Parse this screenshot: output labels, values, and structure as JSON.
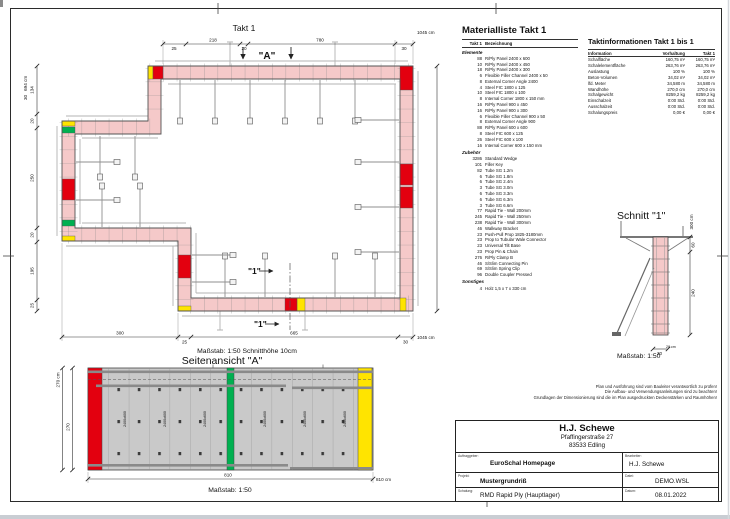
{
  "colors": {
    "wall_pink": "#f5c9c9",
    "accent_red": "#e3000f",
    "accent_green": "#00b050",
    "accent_yellow": "#ffe400",
    "panel_gray": "#c9c9c9",
    "wale_gray": "#b3b3b3",
    "line_dark": "#333333"
  },
  "sheet": {
    "plan_title": "Takt 1",
    "plan_scale": "Maßstab: 1:50   Schnitthöhe 10cm",
    "elevation_title": "Seitenansicht \"A\"",
    "elevation_scale": "Maßstab: 1:50",
    "section_title": "Schnitt \"1\"",
    "section_scale": "Maßstab: 1:50"
  },
  "markers": {
    "a": "\"A\"",
    "s1": "\"1\""
  },
  "dims": {
    "plan_top": [
      "25",
      "218",
      "20",
      "780",
      "30",
      "1045 cm"
    ],
    "plan_left_thickness": "30",
    "plan_left_total": "694 cm",
    "plan_left": [
      "134",
      "20",
      "250",
      "20",
      "195",
      "25"
    ],
    "plan_bottom": [
      "300",
      "25",
      "665",
      "30",
      "1045 cm"
    ],
    "elevation_total": "270 cm",
    "elevation_height": "270",
    "elevation_width": "810",
    "elevation_width_total": "810 cm",
    "section_total": "300 cm",
    "section_upper": "60",
    "section_lower": "240",
    "section_thickness": "30",
    "section_extra": "28 cm"
  },
  "elevation": {
    "panel_label": "2400x600"
  },
  "material_list": {
    "title": "Materialliste  Takt 1",
    "col_qty": "Takt 1",
    "col_name": "Bezeichnung",
    "section1": "Elemente",
    "items1": [
      {
        "qty": "88",
        "name": "R/Ply Panel 2400 x 600"
      },
      {
        "qty": "10",
        "name": "R/Ply Panel 2400 x 450"
      },
      {
        "qty": "18",
        "name": "R/Ply Panel 2400 x 300"
      },
      {
        "qty": "6",
        "name": "Flexible Filler Channel 2400 x 50"
      },
      {
        "qty": "8",
        "name": "External Corner Angle 2400"
      },
      {
        "qty": "4",
        "name": "Steel FIC 1800 x 125"
      },
      {
        "qty": "10",
        "name": "Steel FIC 1800 x 100"
      },
      {
        "qty": "8",
        "name": "Internal Corner 1800 x 150 mm"
      },
      {
        "qty": "16",
        "name": "R/Ply Panel 900 x 450"
      },
      {
        "qty": "16",
        "name": "R/Ply Panel 900 x 300"
      },
      {
        "qty": "6",
        "name": "Flexible Filler Channel 900 x 50"
      },
      {
        "qty": "8",
        "name": "External Corner Angle 900"
      },
      {
        "qty": "88",
        "name": "R/Ply Panel 600 x 600"
      },
      {
        "qty": "8",
        "name": "Steel FIC 600 x 125"
      },
      {
        "qty": "26",
        "name": "Steel FIC 600 x 100"
      },
      {
        "qty": "16",
        "name": "Internal Corner 600 x 150 mm"
      }
    ],
    "section2": "Zubehör",
    "items2": [
      {
        "qty": "3286",
        "name": "Standard Wedge"
      },
      {
        "qty": "101",
        "name": "Filler Key"
      },
      {
        "qty": "82",
        "name": "Tube SG 1.2m"
      },
      {
        "qty": "6",
        "name": "Tube SG 1.8m"
      },
      {
        "qty": "6",
        "name": "Tube SG 2.4m"
      },
      {
        "qty": "3",
        "name": "Tube SG 3.0m"
      },
      {
        "qty": "6",
        "name": "Tube SG 3.3m"
      },
      {
        "qty": "6",
        "name": "Tube SG 6.3m"
      },
      {
        "qty": "3",
        "name": "Tube SG 6.6m"
      },
      {
        "qty": "77",
        "name": "Rapid Tie - Wall  200mm"
      },
      {
        "qty": "245",
        "name": "Rapid Tie - Wall  250mm"
      },
      {
        "qty": "238",
        "name": "Rapid Tie - Wall  300mm"
      },
      {
        "qty": "46",
        "name": "Walkway Bracket"
      },
      {
        "qty": "23",
        "name": "Push-Pull Prop 1825-3180mm"
      },
      {
        "qty": "23",
        "name": "Prop to Tubular Wale Connector"
      },
      {
        "qty": "23",
        "name": "Universal Tilt Base"
      },
      {
        "qty": "23",
        "name": "Prop Pin & Chain"
      },
      {
        "qty": "276",
        "name": "R/Ply Clamp B"
      },
      {
        "qty": "46",
        "name": "S/Slim Connecting Pin"
      },
      {
        "qty": "69",
        "name": "S/Slim Spring Clip"
      },
      {
        "qty": "96",
        "name": "Double Coupler Pressed"
      }
    ],
    "section3": "Sonstiges",
    "items3": [
      {
        "qty": "4",
        "name": "Holz 1,5 x 7 x 330 cm"
      }
    ]
  },
  "takt_info": {
    "title": "Taktinformationen  Takt 1 bis 1",
    "col_info": "Information",
    "col_vorhaltung": "Vorhaltung",
    "col_takt": "Takt 1",
    "rows": [
      {
        "label": "Schalfläche",
        "vorhaltung": "160,75 m²",
        "takt1": "160,75 m²"
      },
      {
        "label": "Schalelementfläche",
        "vorhaltung": "263,76 m²",
        "takt1": "263,76 m²"
      },
      {
        "label": "Auslastung",
        "vorhaltung": "100 %",
        "takt1": "100 %"
      },
      {
        "label": "Beton-Volumen",
        "vorhaltung": "34,02 m³",
        "takt1": "34,02 m³"
      },
      {
        "label": "lfd. Meter",
        "vorhaltung": "34,580 m",
        "takt1": "34,580 m"
      },
      {
        "label": "Wandhöhe",
        "vorhaltung": "270,0 cm",
        "takt1": "270,0 cm"
      },
      {
        "label": "Schalgewicht",
        "vorhaltung": "8259,2 kg",
        "takt1": "8259,2 kg"
      },
      {
        "label": "Einschalzeit",
        "vorhaltung": "0:00 Std.",
        "takt1": "0:00 Std."
      },
      {
        "label": "Ausschalzeit",
        "vorhaltung": "0:00 Std.",
        "takt1": "0:00 Std."
      },
      {
        "label": "Schalungspreis",
        "vorhaltung": "0,00 €",
        "takt1": "0,00 €"
      }
    ]
  },
  "notes": {
    "lines": [
      "Plan und Ausführung sind vom Bauleiter verantwortlich zu prüfen!",
      "Die Aufbau- und Verwendungsanleitungen sind zu beachten!",
      "Grundlagen der Dimensionierung sind die im Plan ausgedruckten Deckenstärken und Raumhöhen!"
    ]
  },
  "title_block": {
    "company": "H.J. Schewe",
    "street": "Pfaffingerstraße 27",
    "city": "83533 Edling",
    "auftraggeber_label": "Auftraggeber:",
    "auftraggeber": "EuroSchal Homepage",
    "bearbeiter_label": "Bearbeiter:",
    "bearbeiter": "H.J. Schewe",
    "projekt_label": "Projekt:",
    "projekt": "Mustergrundriß",
    "datei_label": "Datei:",
    "datei": "DEMO.WSL",
    "schalung_label": "Schalung:",
    "schalung": "RMD Rapid Ply (Hauptlager)",
    "datum_label": "Datum:",
    "datum": "08.01.2022"
  }
}
